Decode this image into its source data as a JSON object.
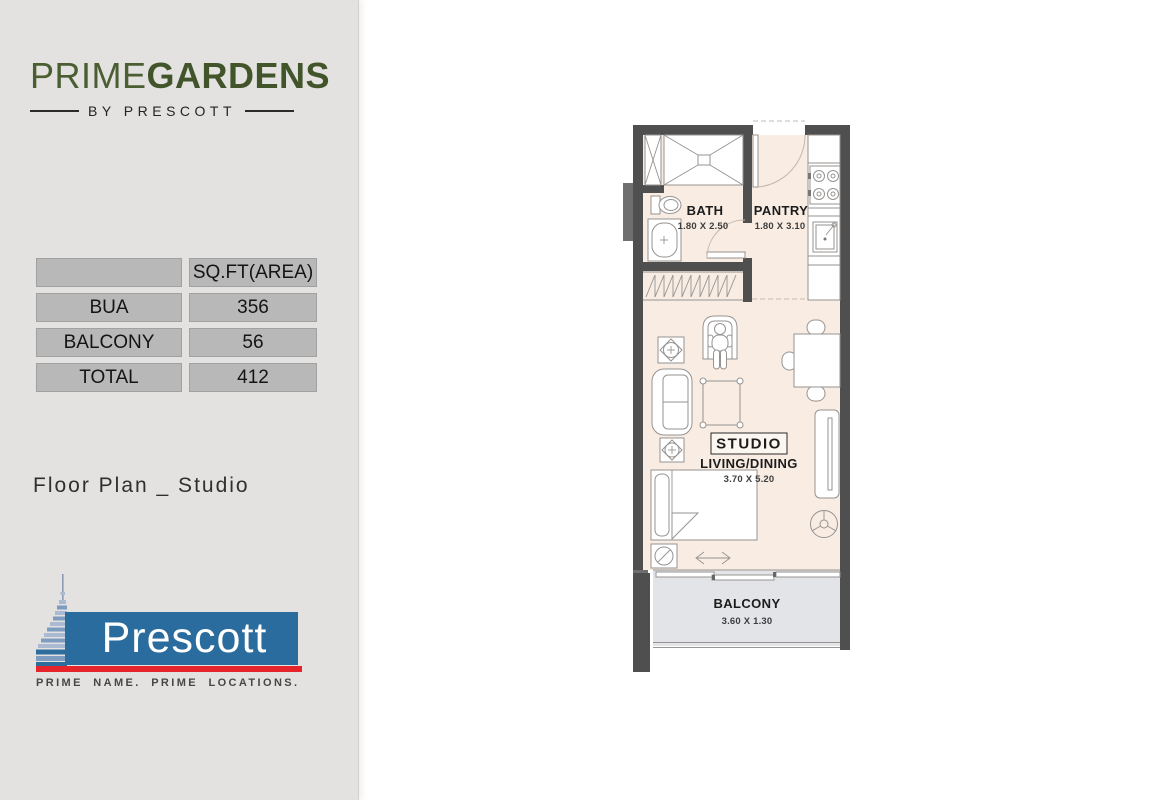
{
  "theme": {
    "page_bg": "#ffffff",
    "sidebar_bg": "#e3e2e1",
    "cell_bg": "#b9b8b8",
    "cell_border": "#a2a1a1",
    "logo_green": "#4a5e31",
    "logo_green_bold": "#42552a",
    "brand_blue": "#2b6c9f",
    "brand_red": "#e6242c",
    "wall": "#4f4f4f",
    "pilaster": "#6f6f6f",
    "floor": "#f8ece3",
    "balcony_floor": "#e2e4e7",
    "line": "#969391"
  },
  "sidebar": {
    "brand": {
      "prime": "PRIME",
      "gardens": "GARDENS",
      "byline": "BY PRESCOTT"
    },
    "area_table": {
      "header": "SQ.FT(AREA)",
      "rows": [
        {
          "label": "BUA",
          "value": "356"
        },
        {
          "label": "BALCONY",
          "value": "56"
        },
        {
          "label": "TOTAL",
          "value": "412"
        }
      ]
    },
    "caption": "Floor Plan _ Studio",
    "developer": {
      "name": "Prescott",
      "tagline": "PRIME NAME.  PRIME LOCATIONS."
    }
  },
  "floor_plan": {
    "bath": {
      "name": "BATH",
      "dims": "1.80 X 2.50"
    },
    "pantry": {
      "name": "PANTRY",
      "dims": "1.80 X 3.10"
    },
    "studio": {
      "title": "STUDIO",
      "subtitle": "LIVING/DINING",
      "dims": "3.70 X 5.20"
    },
    "balcony": {
      "name": "BALCONY",
      "dims": "3.60 X 1.30"
    }
  }
}
